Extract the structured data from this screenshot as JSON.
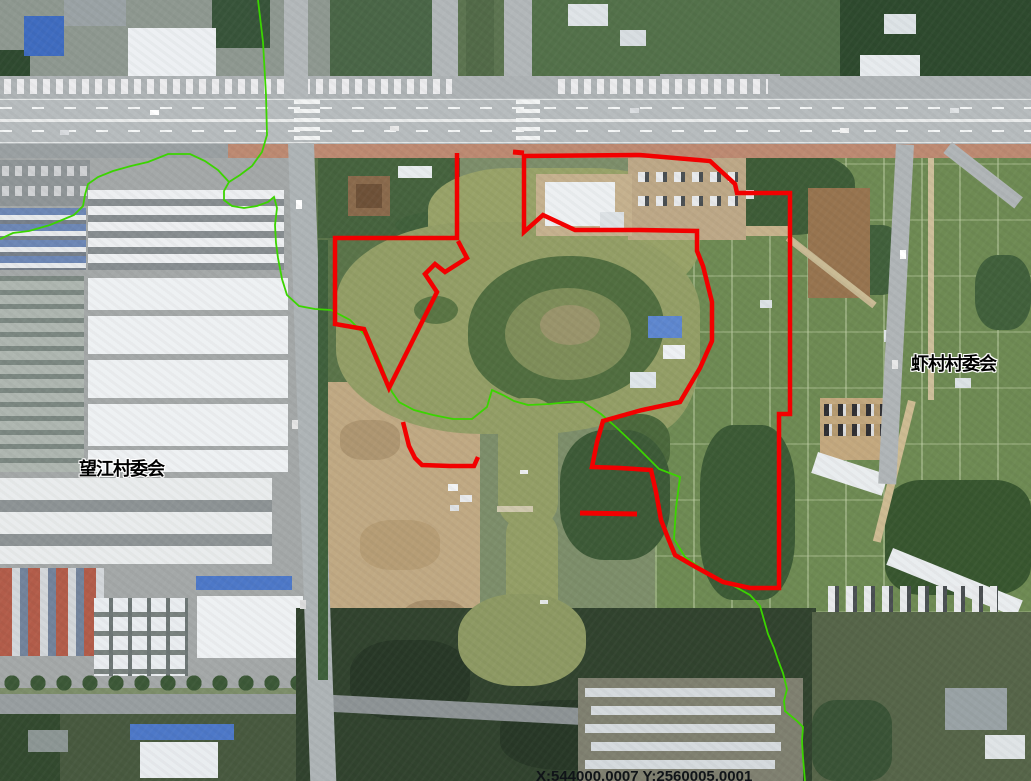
{
  "map": {
    "region_labels": [
      {
        "id": "wangjiang",
        "text": "望江村委会"
      },
      {
        "id": "xiacun",
        "text": "虾村村委会"
      }
    ],
    "coordinate_readout": "X:544000.0007 Y:2560005.0001",
    "overlay_colors": {
      "boundary": "#f20000",
      "guide": "#3bd400"
    },
    "red_boundary_shapes": [
      {
        "name": "boundary-left-parcel",
        "closed": false,
        "width": 4.5,
        "points": [
          [
            457,
            153
          ],
          [
            457,
            238
          ],
          [
            335,
            238
          ],
          [
            335,
            324
          ],
          [
            364,
            329
          ],
          [
            389,
            388
          ],
          [
            437,
            292
          ],
          [
            425,
            274
          ],
          [
            435,
            264
          ],
          [
            445,
            272
          ],
          [
            467,
            258
          ],
          [
            458,
            241
          ]
        ]
      },
      {
        "name": "boundary-right-parcel",
        "closed": true,
        "width": 4.5,
        "points": [
          [
            524,
            156
          ],
          [
            640,
            155
          ],
          [
            710,
            161
          ],
          [
            735,
            184
          ],
          [
            737,
            193
          ],
          [
            790,
            193
          ],
          [
            790,
            414
          ],
          [
            779,
            414
          ],
          [
            779,
            588
          ],
          [
            750,
            588
          ],
          [
            723,
            582
          ],
          [
            694,
            566
          ],
          [
            675,
            555
          ],
          [
            668,
            538
          ],
          [
            661,
            520
          ],
          [
            656,
            492
          ],
          [
            651,
            470
          ],
          [
            620,
            468
          ],
          [
            592,
            467
          ],
          [
            597,
            442
          ],
          [
            603,
            421
          ],
          [
            642,
            410
          ],
          [
            680,
            402
          ],
          [
            700,
            368
          ],
          [
            712,
            341
          ],
          [
            712,
            302
          ],
          [
            703,
            266
          ],
          [
            697,
            251
          ],
          [
            697,
            231
          ],
          [
            640,
            230
          ],
          [
            575,
            230
          ],
          [
            543,
            215
          ],
          [
            524,
            232
          ]
        ]
      },
      {
        "name": "boundary-lower-segment",
        "closed": false,
        "width": 4.5,
        "points": [
          [
            403,
            422
          ],
          [
            409,
            446
          ],
          [
            415,
            458
          ],
          [
            422,
            465
          ],
          [
            450,
            466
          ],
          [
            474,
            466
          ],
          [
            478,
            457
          ]
        ]
      },
      {
        "name": "boundary-top-tick",
        "closed": false,
        "width": 5,
        "points": [
          [
            513,
            152
          ],
          [
            524,
            153
          ]
        ]
      },
      {
        "name": "boundary-mid-dash",
        "closed": false,
        "width": 5,
        "points": [
          [
            580,
            513
          ],
          [
            637,
            514
          ]
        ]
      }
    ],
    "green_guide_lines": [
      {
        "name": "guide-line-main",
        "closed": false,
        "points": [
          [
            258,
            0
          ],
          [
            263,
            42
          ],
          [
            266,
            95
          ],
          [
            267,
            135
          ],
          [
            262,
            152
          ],
          [
            252,
            166
          ],
          [
            240,
            175
          ],
          [
            229,
            182
          ],
          [
            224,
            191
          ],
          [
            224,
            200
          ],
          [
            232,
            206
          ],
          [
            244,
            208
          ],
          [
            257,
            206
          ],
          [
            268,
            202
          ],
          [
            274,
            197
          ],
          [
            277,
            208
          ],
          [
            275,
            225
          ],
          [
            276,
            243
          ],
          [
            278,
            258
          ],
          [
            282,
            279
          ],
          [
            287,
            295
          ],
          [
            299,
            306
          ],
          [
            315,
            309
          ],
          [
            331,
            310
          ],
          [
            350,
            320
          ],
          [
            367,
            337
          ],
          [
            378,
            357
          ],
          [
            386,
            377
          ],
          [
            392,
            392
          ],
          [
            399,
            402
          ],
          [
            414,
            410
          ],
          [
            433,
            415
          ],
          [
            453,
            419
          ],
          [
            472,
            419
          ],
          [
            487,
            407
          ],
          [
            492,
            390
          ],
          [
            503,
            395
          ],
          [
            514,
            401
          ],
          [
            528,
            405
          ],
          [
            550,
            404
          ],
          [
            568,
            402
          ],
          [
            583,
            402
          ],
          [
            601,
            414
          ],
          [
            617,
            428
          ],
          [
            636,
            446
          ],
          [
            659,
            469
          ],
          [
            680,
            477
          ],
          [
            676,
            508
          ],
          [
            674,
            539
          ],
          [
            685,
            557
          ],
          [
            703,
            570
          ],
          [
            732,
            585
          ],
          [
            750,
            595
          ],
          [
            760,
            606
          ],
          [
            764,
            620
          ],
          [
            768,
            634
          ],
          [
            774,
            648
          ],
          [
            778,
            660
          ],
          [
            783,
            673
          ],
          [
            787,
            689
          ],
          [
            784,
            701
          ],
          [
            785,
            711
          ],
          [
            797,
            721
          ],
          [
            803,
            727
          ],
          [
            802,
            741
          ],
          [
            803,
            758
          ],
          [
            805,
            781
          ]
        ]
      },
      {
        "name": "guide-line-west-branch",
        "closed": false,
        "points": [
          [
            0,
            239
          ],
          [
            13,
            233
          ],
          [
            29,
            231
          ],
          [
            50,
            225
          ],
          [
            74,
            215
          ],
          [
            83,
            206
          ],
          [
            85,
            195
          ],
          [
            88,
            184
          ],
          [
            98,
            177
          ],
          [
            113,
            171
          ],
          [
            131,
            166
          ],
          [
            148,
            162
          ],
          [
            168,
            154
          ],
          [
            190,
            154
          ],
          [
            205,
            161
          ],
          [
            218,
            170
          ],
          [
            229,
            182
          ]
        ]
      }
    ]
  }
}
